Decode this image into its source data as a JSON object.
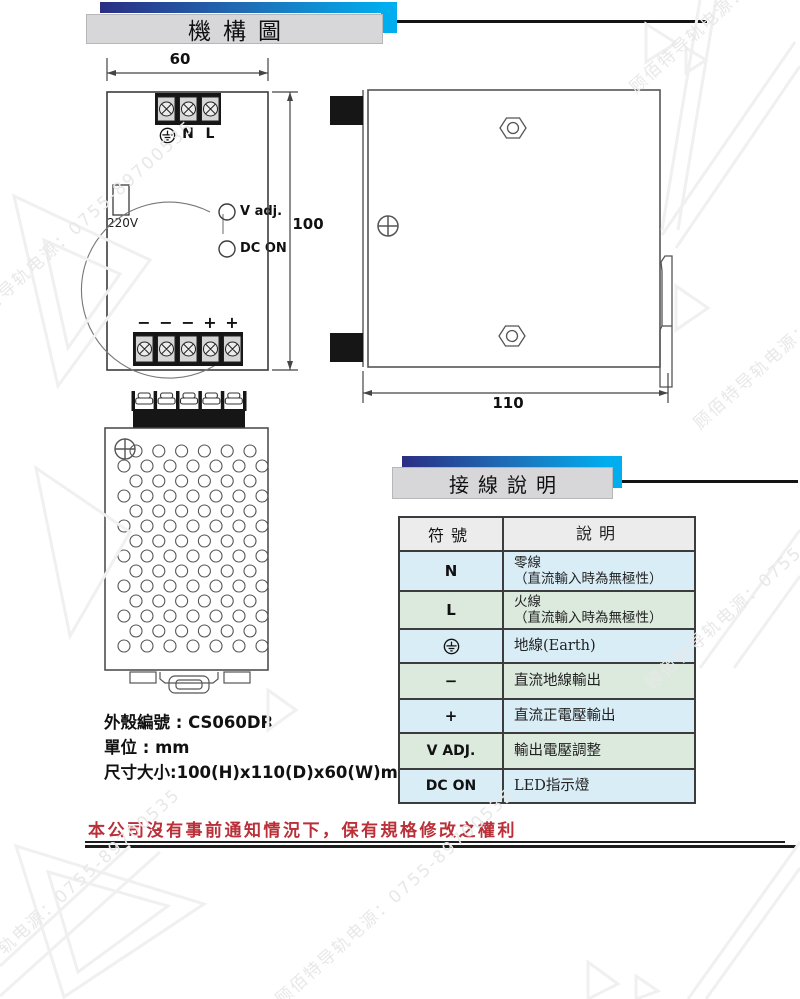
{
  "banners": {
    "mechanism": {
      "title": "機構圖"
    },
    "wiring": {
      "title": "接線說明"
    }
  },
  "front_view": {
    "dim_width": "60",
    "dim_height": "100",
    "terminal_labels": {
      "earth": "earth-icon",
      "n": "N",
      "l": "L"
    },
    "switch_label": "220V",
    "vadj_label": "V adj.",
    "dcon_label": "DC ON",
    "polarity": [
      "−",
      "−",
      "−",
      "+",
      "+"
    ]
  },
  "side_view": {
    "dim_depth": "110"
  },
  "notes": {
    "case_no": "外殼編號 : CS060DR",
    "unit": "單位 : mm",
    "size": "尺寸大小:100(H)x110(D)x60(W)mm"
  },
  "wiring_table": {
    "headers": [
      "符號",
      "說明"
    ],
    "rows": [
      {
        "symbol": "N",
        "desc_line1": "零線",
        "desc_line2": "（直流輸入時為無極性）"
      },
      {
        "symbol": "L",
        "desc_line1": "火線",
        "desc_line2": "（直流輸入時為無極性）"
      },
      {
        "symbol": "",
        "icon": "earth-icon",
        "desc_line1": "地線(Earth)",
        "desc_line2": ""
      },
      {
        "symbol": "−",
        "desc_line1": "直流地線輸出",
        "desc_line2": ""
      },
      {
        "symbol": "+",
        "desc_line1": "直流正電壓輸出",
        "desc_line2": ""
      },
      {
        "symbol": "V ADJ.",
        "desc_line1": "輸出電壓調整",
        "desc_line2": ""
      },
      {
        "symbol": "DC ON",
        "desc_line1": "LED指示燈",
        "desc_line2": ""
      }
    ]
  },
  "footer": {
    "disclaimer": "本公司沒有事前通知情況下，保有規格修改之權利"
  },
  "watermark": {
    "text": "顾佰特导轨电源：0755-89700535"
  },
  "colors": {
    "banner_gradient_start": "#2b2e83",
    "banner_gradient_end": "#00aeef",
    "banner_box": "#d7d7d9",
    "table_header_bg": "#ececec",
    "table_row_blue": "#d9edf7",
    "table_row_green": "#dceade",
    "disclaimer_red": "#b93038"
  }
}
